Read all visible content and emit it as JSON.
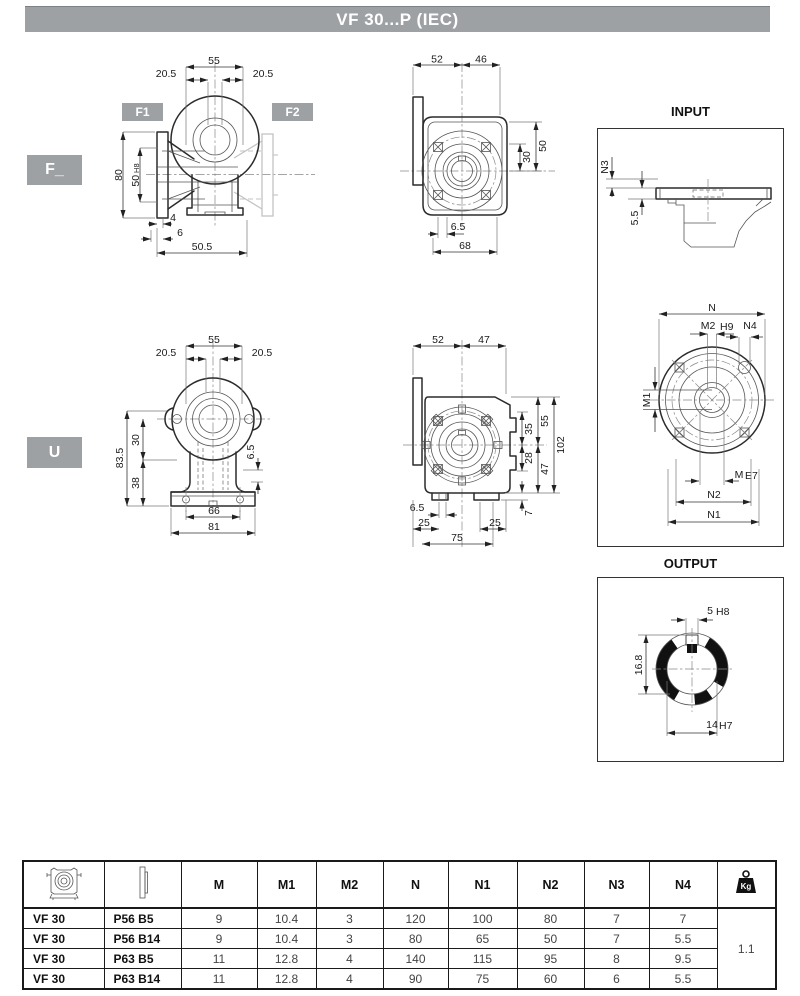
{
  "page": {
    "title": "VF 30...P (IEC)"
  },
  "labels": {
    "f": "F_",
    "u": "U",
    "f1": "F1",
    "f2": "F2",
    "input": "INPUT",
    "output": "OUTPUT"
  },
  "dims": {
    "f_side": {
      "w": "55",
      "ol": "20.5",
      "or": "20.5",
      "h": "80",
      "bore": "50",
      "bore_tol": "H8",
      "t1": "4",
      "t2": "6",
      "depth": "50.5"
    },
    "f_front": {
      "a": "52",
      "b": "46",
      "c": "50",
      "d": "30",
      "e": "6.5",
      "f": "68"
    },
    "input": {
      "n3": "N3",
      "g": "5.5",
      "n": "N",
      "m2": "M2",
      "m2_tol": "H9",
      "n4": "N4",
      "m1": "M1",
      "m": "M",
      "m_tol": "E7",
      "n2": "N2",
      "n1": "N1"
    },
    "u_front": {
      "w": "55",
      "ol": "20.5",
      "or": "20.5",
      "h": "83.5",
      "c1": "30",
      "c2": "38",
      "fh": "6.5",
      "b1": "66",
      "b2": "81"
    },
    "u_side": {
      "a": "52",
      "b": "47",
      "r1": "55",
      "r2": "35",
      "r3": "28",
      "r4": "47",
      "r5": "102",
      "r6": "7",
      "s": "6.5",
      "p1": "25",
      "p2": "25",
      "p3": "75"
    },
    "output": {
      "k": "5",
      "k_tol": "H8",
      "d": "16.8",
      "bore": "14",
      "bore_tol": "H7"
    }
  },
  "table": {
    "headers": {
      "m": "M",
      "m1": "M1",
      "m2": "M2",
      "n": "N",
      "n1": "N1",
      "n2": "N2",
      "n3": "N3",
      "n4": "N4"
    },
    "kg_label": "Kg",
    "rows": [
      {
        "model": "VF 30",
        "version": "P56 B5",
        "m": "9",
        "m1": "10.4",
        "m2": "3",
        "n": "120",
        "n1": "100",
        "n2": "80",
        "n3": "7",
        "n4": "7"
      },
      {
        "model": "VF 30",
        "version": "P56 B14",
        "m": "9",
        "m1": "10.4",
        "m2": "3",
        "n": "80",
        "n1": "65",
        "n2": "50",
        "n3": "7",
        "n4": "5.5"
      },
      {
        "model": "VF 30",
        "version": "P63 B5",
        "m": "11",
        "m1": "12.8",
        "m2": "4",
        "n": "140",
        "n1": "115",
        "n2": "95",
        "n3": "8",
        "n4": "9.5"
      },
      {
        "model": "VF 30",
        "version": "P63 B14",
        "m": "11",
        "m1": "12.8",
        "m2": "4",
        "n": "90",
        "n1": "75",
        "n2": "60",
        "n3": "6",
        "n4": "5.5"
      }
    ],
    "weight": "1.1"
  }
}
